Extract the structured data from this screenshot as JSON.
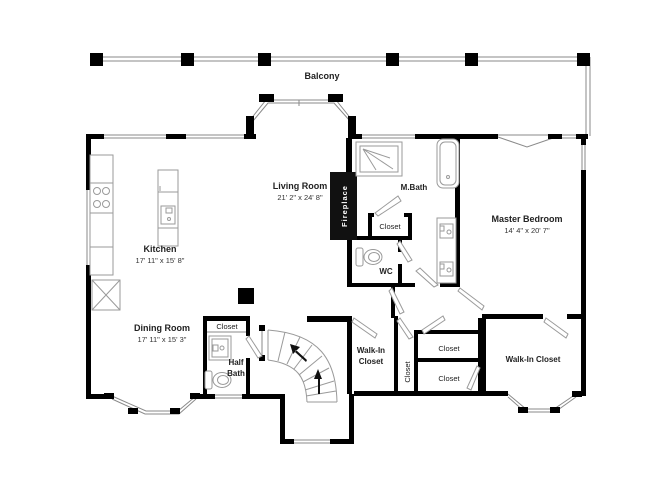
{
  "colors": {
    "wall": "#000000",
    "window": "#8a8a8a",
    "fixture": "#9a9a9a",
    "text": "#222222",
    "fireplace_bg": "#111111",
    "fireplace_text": "#ffffff",
    "background": "#ffffff"
  },
  "balcony": {
    "label": "Balcony"
  },
  "rooms": {
    "living_room": {
      "name": "Living Room",
      "dims": "21' 2\" x 24' 8\""
    },
    "kitchen": {
      "name": "Kitchen",
      "dims": "17' 11\" x 15' 8\""
    },
    "dining_room": {
      "name": "Dining Room",
      "dims": "17' 11\" x 15' 3\""
    },
    "master_bedroom": {
      "name": "Master Bedroom",
      "dims": "14' 4\" x 20' 7\""
    },
    "master_bath": {
      "name": "M.Bath"
    },
    "wc": {
      "name": "WC"
    },
    "half_bath": {
      "line1": "Half",
      "line2": "Bath"
    },
    "fireplace": {
      "name": "Fireplace"
    },
    "walk_in_closet_mid": {
      "line1": "Walk-In",
      "line2": "Closet"
    },
    "walk_in_closet_right": {
      "name": "Walk-In Closet"
    }
  },
  "closets": {
    "master_bath_closet": "Closet",
    "half_bath_closet": "Closet",
    "hall_closet_vertical": "Closet",
    "hall_closet_upper": "Closet",
    "hall_closet_lower": "Closet"
  },
  "fixtures": {
    "balcony_posts": "column-icon",
    "stove": "stove-icon",
    "kitchen_island": "kitchen-island-icon",
    "dumbwaiter": "shaft-x-icon",
    "shower": "shower-icon",
    "bathtub": "bathtub-icon",
    "toilet_wc": "toilet-icon",
    "toilet_half_bath": "toilet-icon",
    "vanity_double_sink": "double-sink-icon",
    "half_bath_sink": "sink-icon",
    "staircase": "curved-stairs-icon"
  }
}
